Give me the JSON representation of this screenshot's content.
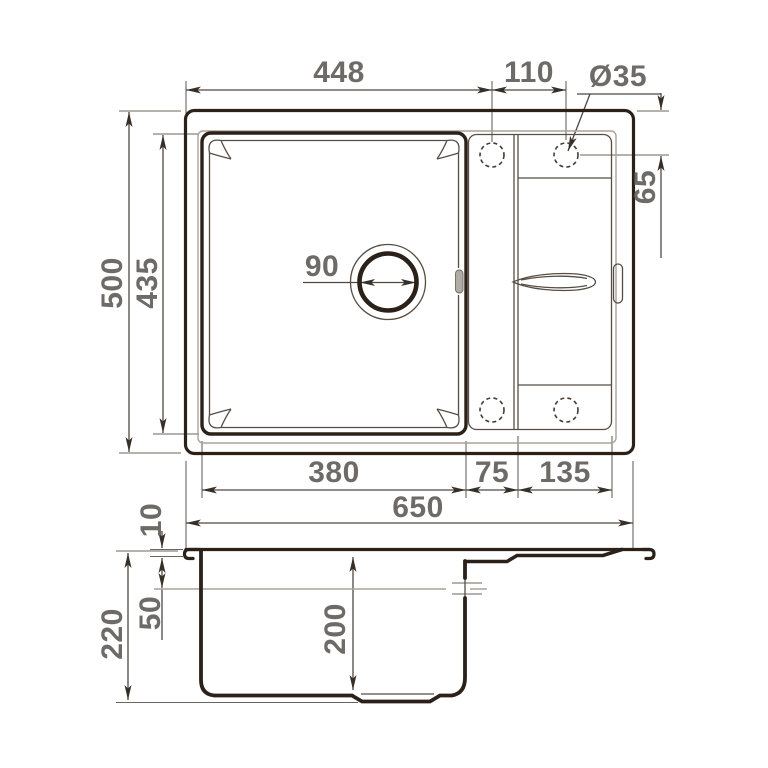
{
  "drawing_title": "Kitchen sink dimensional drawing (top view and section view)",
  "colors": {
    "background": "#ffffff",
    "outline_bold": "#2b2119",
    "outline_thin": "#574d45",
    "rim_inner_gray": "#a9a29a",
    "dimension_lines": "#4e4740",
    "dimension_text": "#6e6a67"
  },
  "top_view": {
    "dims": {
      "tap_line_offset": "448",
      "tap_spacing": "110",
      "tap_hole_diameter": "Ø35",
      "overall_depth": "500",
      "bowl_depth": "435",
      "drain_diameter": "90",
      "tap_edge_offset": "65",
      "bowl_width": "380",
      "tap_ledge_width": "75",
      "wing_width": "135",
      "overall_width": "650"
    }
  },
  "side_view": {
    "dims": {
      "rim_thickness": "10",
      "overflow_depth": "50",
      "overall_height": "220",
      "bowl_inner_depth": "200"
    }
  }
}
